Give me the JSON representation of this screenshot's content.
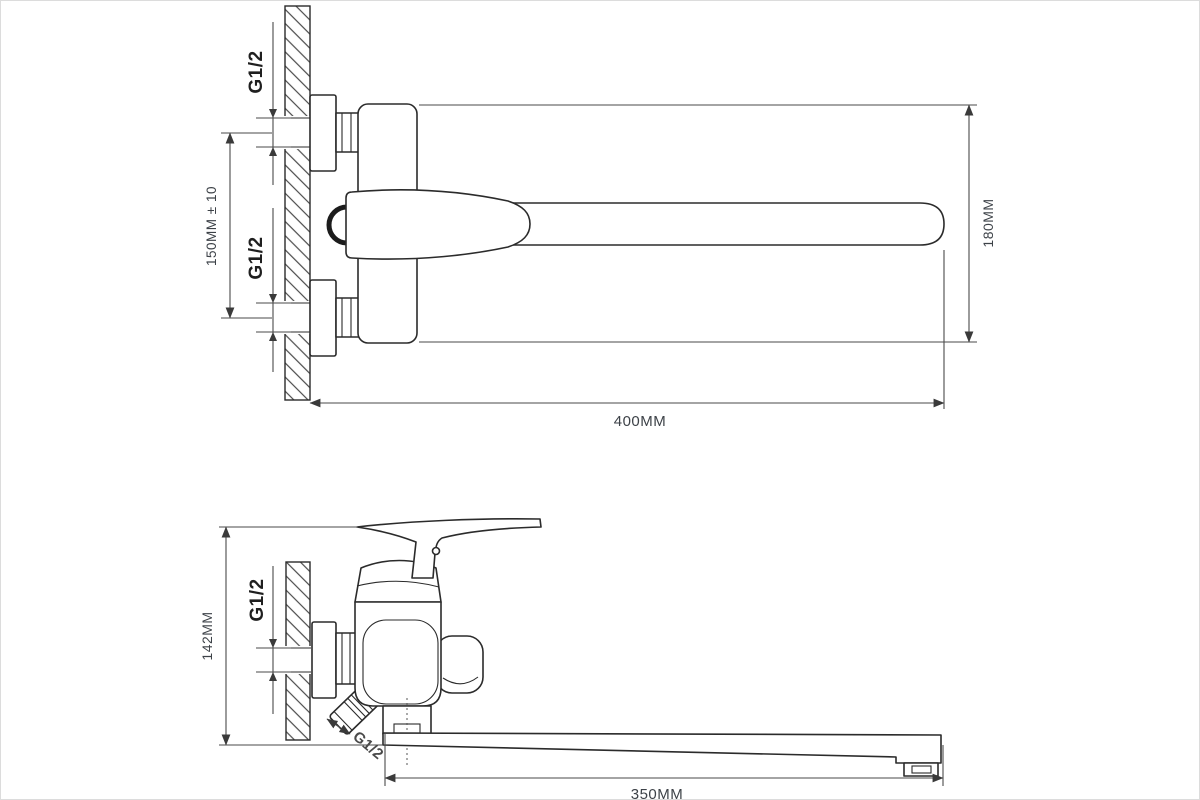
{
  "title": "Wall-mounted bath mixer technical drawing, two projection views",
  "colors": {
    "background": "#ffffff",
    "line": "#2b2b2b",
    "dimension_line": "#4a4a4a",
    "dimension_text": "#3d4248",
    "height_dimension_text": "#4e5a6b",
    "thread_text": "#1f1f1f"
  },
  "top_view": {
    "thread_top_label": "G1/2",
    "thread_bottom_label": "G1/2",
    "inlet_spacing_label": "150MM ± 10",
    "height_label": "180MM",
    "reach_label": "400MM"
  },
  "side_view": {
    "thread_wall_label": "G1/2",
    "thread_outlet_label": "G1/2",
    "height_label": "142MM",
    "spout_label": "350MM"
  }
}
